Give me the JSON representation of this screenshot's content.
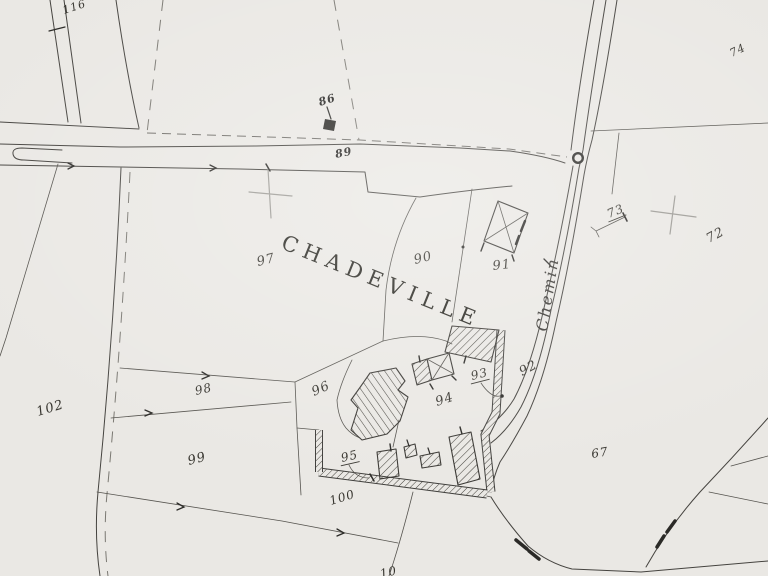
{
  "map": {
    "type": "cadastral-scan",
    "place_name": "CHADEVILLE",
    "road_name": "Chemin",
    "colors": {
      "paper": "#eae8e4",
      "ink": "#45433f",
      "pencil": "#9c9a95",
      "dark": "#2b2a27"
    },
    "title_label": {
      "name": "place-name-label",
      "text": "CHADEVILLE",
      "x": 280,
      "y": 248,
      "rot": 22,
      "size": 21,
      "spacing": 6.5
    },
    "road_label": {
      "name": "road-name-label",
      "text": "Chemin",
      "x": 547,
      "y": 332,
      "rot": -81,
      "size": 16,
      "spacing": 2
    },
    "parcel_labels": [
      {
        "name": "parcel-label-116",
        "text": "116",
        "x": 64,
        "y": 14,
        "rot": -18,
        "size": 11
      },
      {
        "name": "marker-label-86",
        "text": "86",
        "x": 320,
        "y": 106,
        "rot": -18,
        "size": 11,
        "bold": true
      },
      {
        "name": "marker-label-89",
        "text": "89",
        "x": 336,
        "y": 158,
        "rot": -12,
        "size": 11,
        "bold": true
      },
      {
        "name": "parcel-label-74",
        "text": "74",
        "x": 732,
        "y": 57,
        "rot": -26,
        "size": 11
      },
      {
        "name": "parcel-label-72",
        "text": "72",
        "x": 709,
        "y": 243,
        "rot": -28,
        "size": 13
      },
      {
        "name": "parcel-label-73",
        "text": "73",
        "x": 609,
        "y": 218,
        "rot": -22,
        "size": 12,
        "underline": true
      },
      {
        "name": "parcel-label-97",
        "text": "97",
        "x": 258,
        "y": 266,
        "rot": -14,
        "size": 13
      },
      {
        "name": "parcel-label-90",
        "text": "90",
        "x": 415,
        "y": 264,
        "rot": -14,
        "size": 13
      },
      {
        "name": "parcel-label-91",
        "text": "91",
        "x": 493,
        "y": 270,
        "rot": -6,
        "size": 13
      },
      {
        "name": "parcel-label-92",
        "text": "92",
        "x": 522,
        "y": 376,
        "rot": -28,
        "size": 13
      },
      {
        "name": "parcel-label-93",
        "text": "93",
        "x": 472,
        "y": 380,
        "rot": -14,
        "size": 12,
        "underline": true
      },
      {
        "name": "parcel-label-94",
        "text": "94",
        "x": 437,
        "y": 406,
        "rot": -18,
        "size": 13
      },
      {
        "name": "parcel-label-95",
        "text": "95",
        "x": 342,
        "y": 462,
        "rot": -13,
        "size": 12,
        "underline": true
      },
      {
        "name": "parcel-label-96",
        "text": "96",
        "x": 314,
        "y": 396,
        "rot": -24,
        "size": 13
      },
      {
        "name": "parcel-label-98",
        "text": "98",
        "x": 196,
        "y": 395,
        "rot": -13,
        "size": 12
      },
      {
        "name": "parcel-label-99",
        "text": "99",
        "x": 189,
        "y": 465,
        "rot": -15,
        "size": 13
      },
      {
        "name": "parcel-label-100",
        "text": "100",
        "x": 331,
        "y": 505,
        "rot": -17,
        "size": 12
      },
      {
        "name": "parcel-label-102",
        "text": "102",
        "x": 38,
        "y": 416,
        "rot": -17,
        "size": 13
      },
      {
        "name": "parcel-label-67",
        "text": "67",
        "x": 592,
        "y": 458,
        "rot": -9,
        "size": 12
      },
      {
        "name": "parcel-label-10",
        "text": "10",
        "x": 381,
        "y": 578,
        "rot": -13,
        "size": 12
      }
    ]
  }
}
